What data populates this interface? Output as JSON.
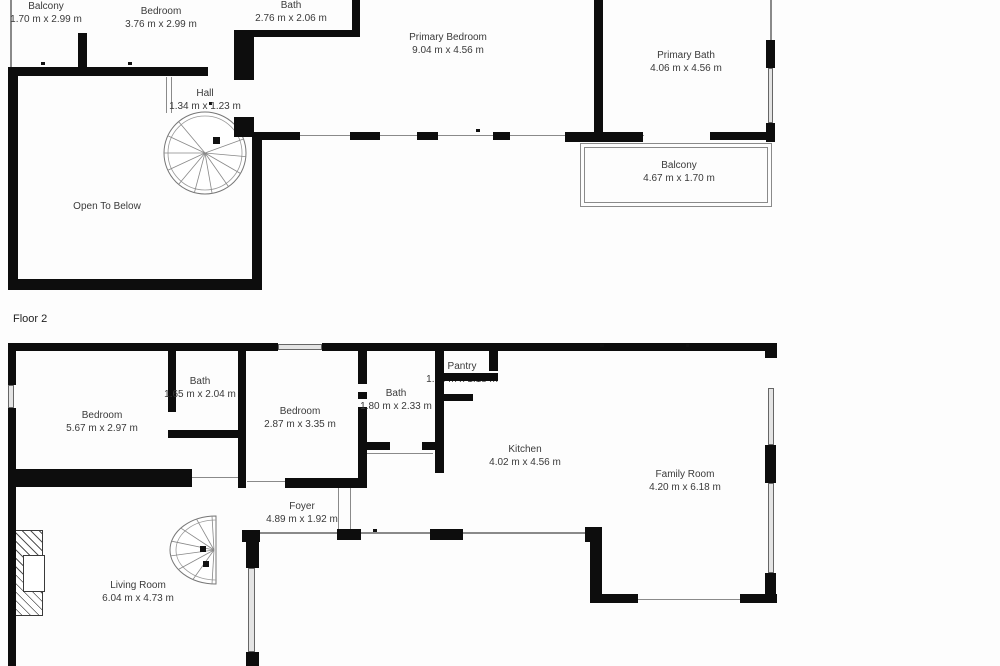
{
  "title": "Two-floor residential floor plan",
  "colors": {
    "wall": "#0d0d0d",
    "window": "#e4e4e4",
    "railing_line": "#8a8a8a",
    "text": "#3a3a3a",
    "background": "#fdfdfd"
  },
  "floors": [
    {
      "label": "",
      "rooms": [
        {
          "name": "Balcony",
          "dims": "1.70 m x 2.99 m"
        },
        {
          "name": "Bedroom",
          "dims": "3.76 m x 2.99 m"
        },
        {
          "name": "Bath",
          "dims": "2.76 m x 2.06 m"
        },
        {
          "name": "Hall",
          "dims": "1.34 m x 1.23 m"
        },
        {
          "name": "Primary Bedroom",
          "dims": "9.04 m x 4.56 m"
        },
        {
          "name": "Primary Bath",
          "dims": "4.06 m x 4.56 m"
        },
        {
          "name": "Balcony",
          "dims": "4.67 m x 1.70 m"
        },
        {
          "name": "Open To Below",
          "dims": ""
        }
      ]
    },
    {
      "label": "Floor 2",
      "rooms": [
        {
          "name": "Bedroom",
          "dims": "5.67 m x 2.97 m"
        },
        {
          "name": "Bath",
          "dims": "1.65 m x 2.04 m"
        },
        {
          "name": "Bedroom",
          "dims": "2.87 m x 3.35 m"
        },
        {
          "name": "Bath",
          "dims": "1.80 m x 2.33 m"
        },
        {
          "name": "Pantry",
          "dims": "1.53 m x 1.18 m"
        },
        {
          "name": "Kitchen",
          "dims": "4.02 m x 4.56 m"
        },
        {
          "name": "Family Room",
          "dims": "4.20 m x 6.18 m"
        },
        {
          "name": "Foyer",
          "dims": "4.89 m x 1.92 m"
        },
        {
          "name": "Living Room",
          "dims": "6.04 m x 4.73 m"
        }
      ]
    }
  ]
}
